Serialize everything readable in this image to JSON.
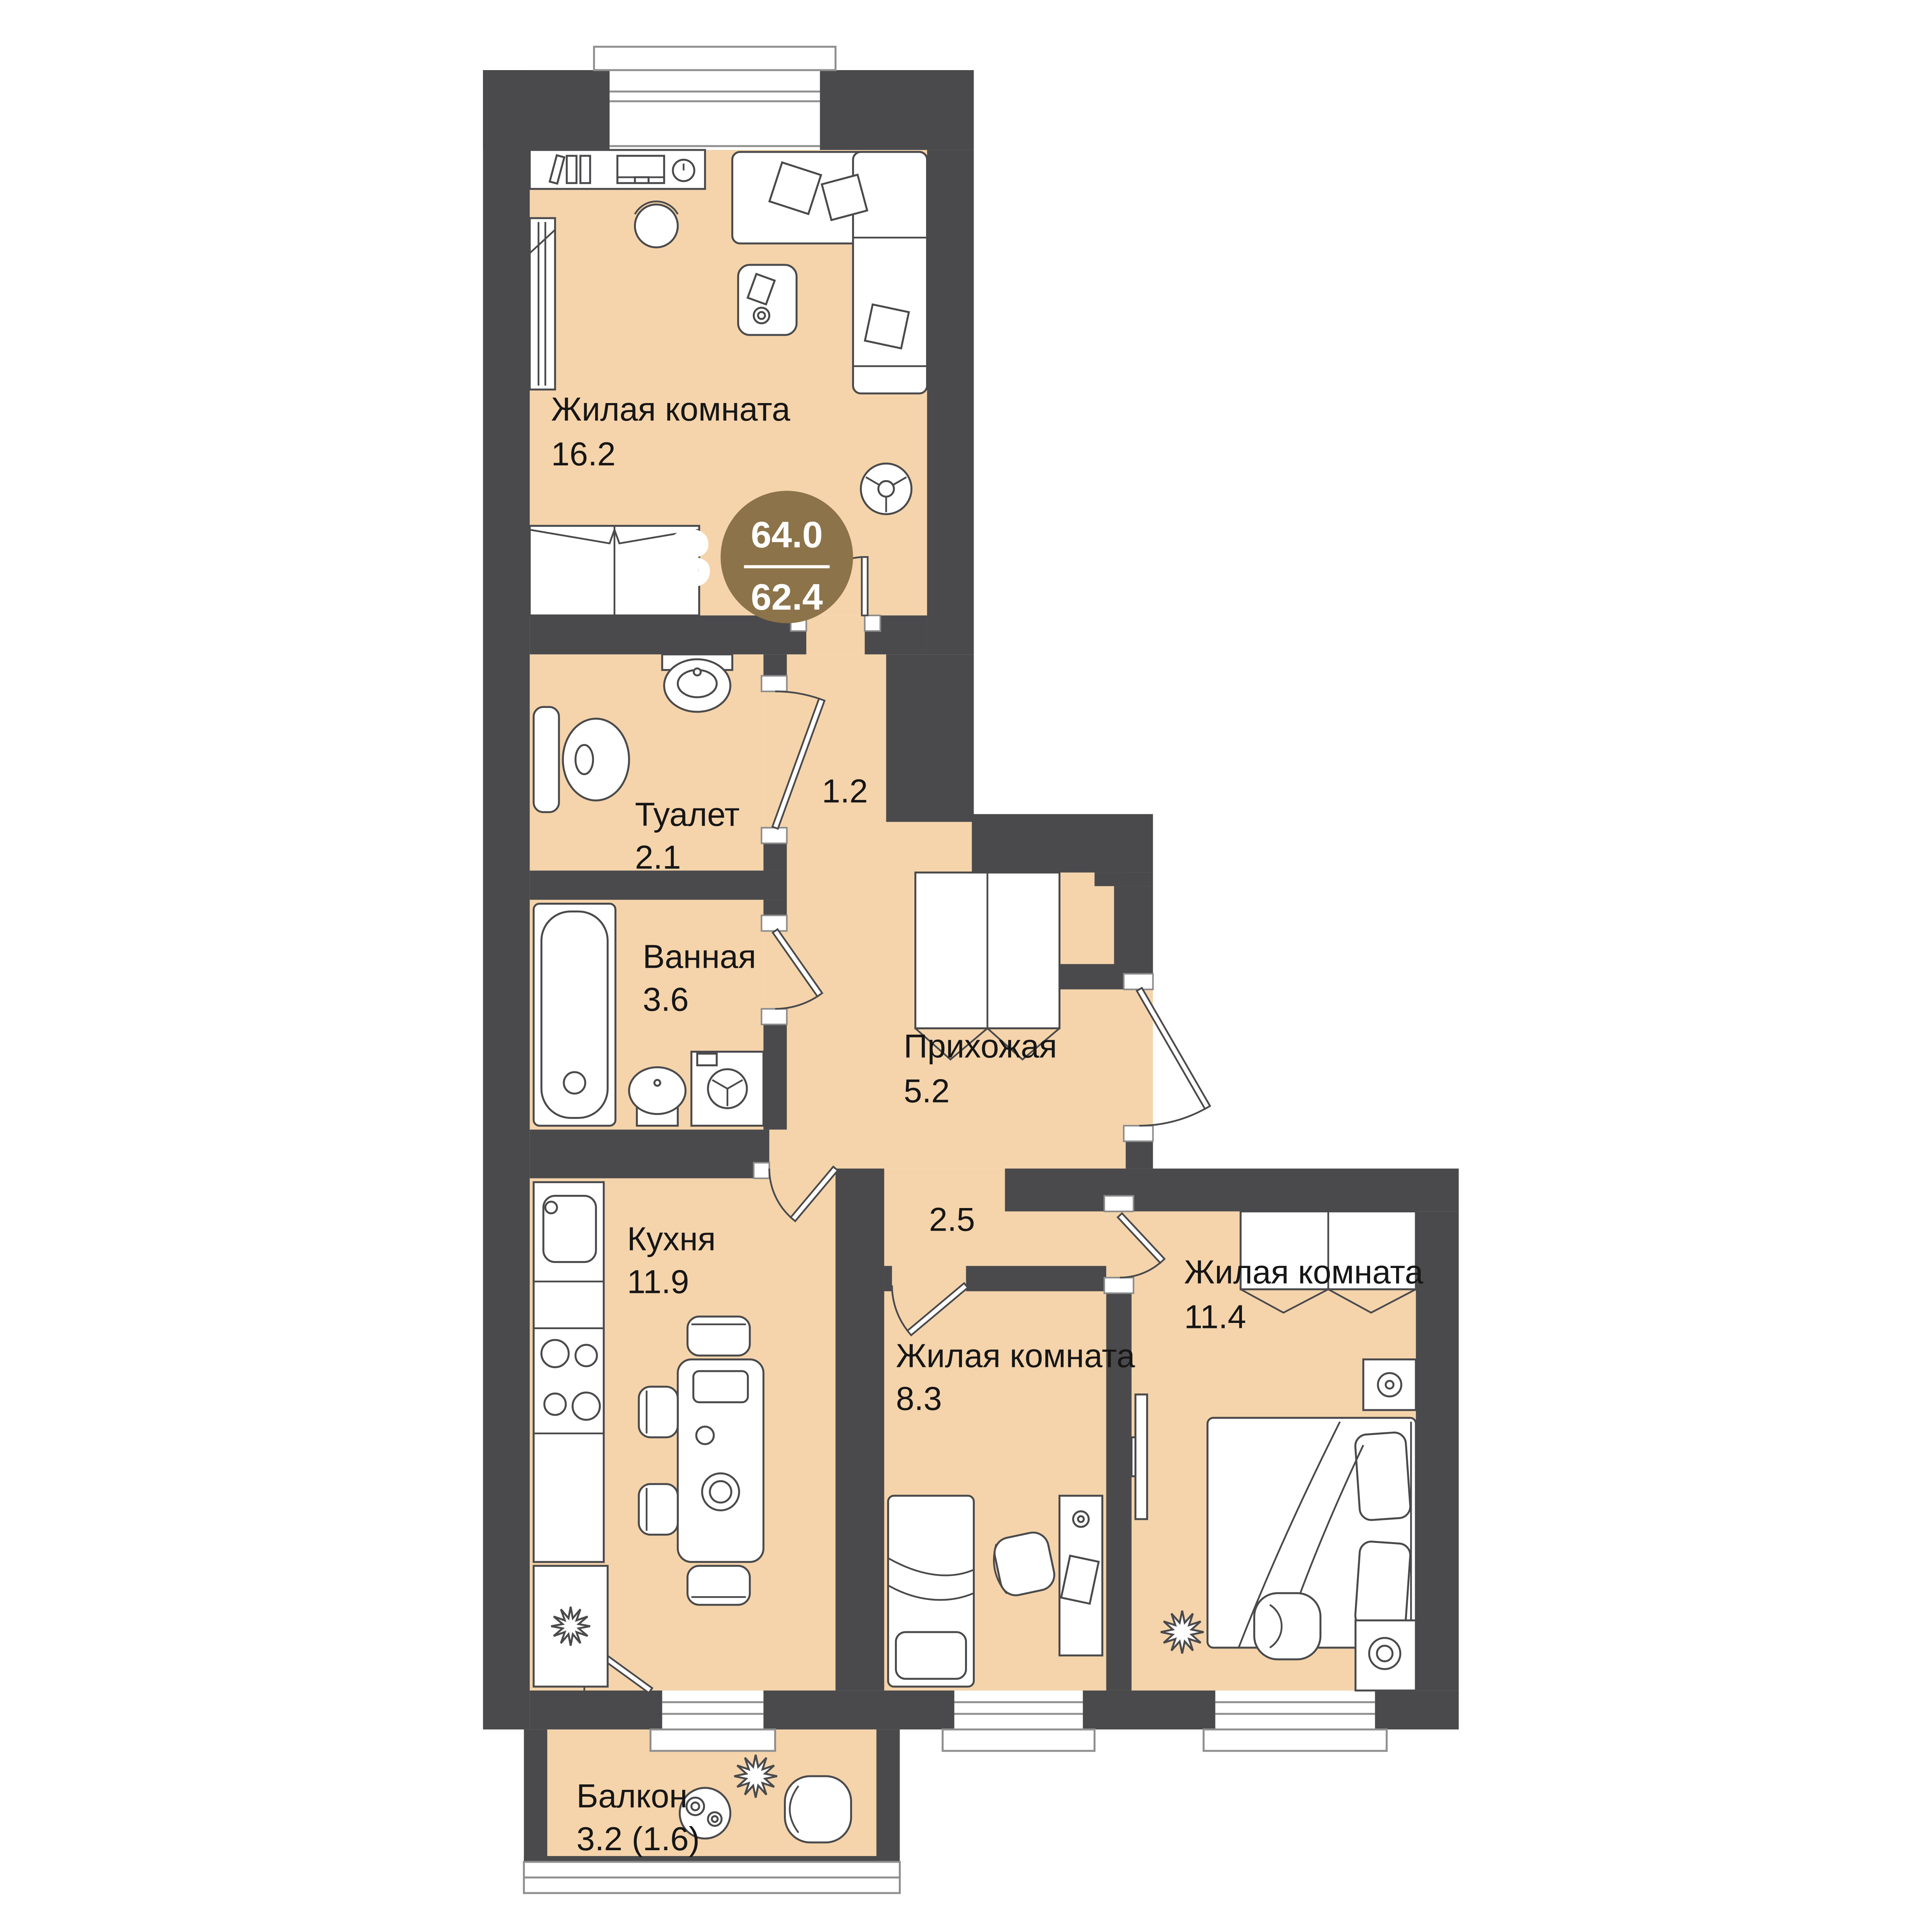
{
  "badge": {
    "rooms_count": "3",
    "total_area": "64.0",
    "living_area": "62.4"
  },
  "rooms": {
    "living_room_1": {
      "label": "Жилая комната",
      "area": "16.2"
    },
    "toilet": {
      "label": "Туалет",
      "area": "2.1"
    },
    "corridor_1": {
      "area": "1.2"
    },
    "bathroom": {
      "label": "Ванная",
      "area": "3.6"
    },
    "hallway": {
      "label": "Прихожая",
      "area": "5.2"
    },
    "corridor_2": {
      "area": "2.5"
    },
    "kitchen": {
      "label": "Кухня",
      "area": "11.9"
    },
    "living_room_2": {
      "label": "Жилая комната",
      "area": "8.3"
    },
    "living_room_3": {
      "label": "Жилая комната",
      "area": "11.4"
    },
    "balcony": {
      "label": "Балкон",
      "area": "3.2 (1.6)"
    }
  },
  "colors": {
    "background": "#ffffff",
    "wall": "#4a4a4c",
    "floor": "#f5d4ab",
    "badge": "#8c7349",
    "badge_text": "#ffffff",
    "label": "#161616",
    "furniture_outline": "#4a4a4c"
  },
  "icons": {
    "bathtub-icon": "rounded rect with inner pill and drain circle",
    "toilet-icon": "tank pill + oval bowl",
    "wall-sink-icon": "half-oval basin with tap dot",
    "pedestal-sink-icon": "oval bowl on base",
    "washing-machine-icon": "square with 3-spoke drum circle",
    "stove-icon": "four burner circles",
    "fridge-icon": "square with snowflake",
    "dining-table-icon": "rounded rect with plate circles",
    "chair-icon": "rounded square seat",
    "sofa-icon": "L-shaped couch with diamond pillows",
    "coffee-table-icon": "rounded rect with book and cup",
    "pouf-icon": "circle with Y spokes",
    "desk-icon": "rect with books, monitor, clock",
    "bed-double-icon": "rect with two pillows and blanket folds",
    "bed-single-icon": "rect with pillow",
    "wardrobe-icon": "rect with split and V door marks",
    "tv-icon": "thin wall rect",
    "armchair-icon": "rounded square with inner arc",
    "plant-icon": "12-point star",
    "door-icon": "leaf with quarter arc",
    "window-icon": "white gap with frame lines and sill"
  }
}
